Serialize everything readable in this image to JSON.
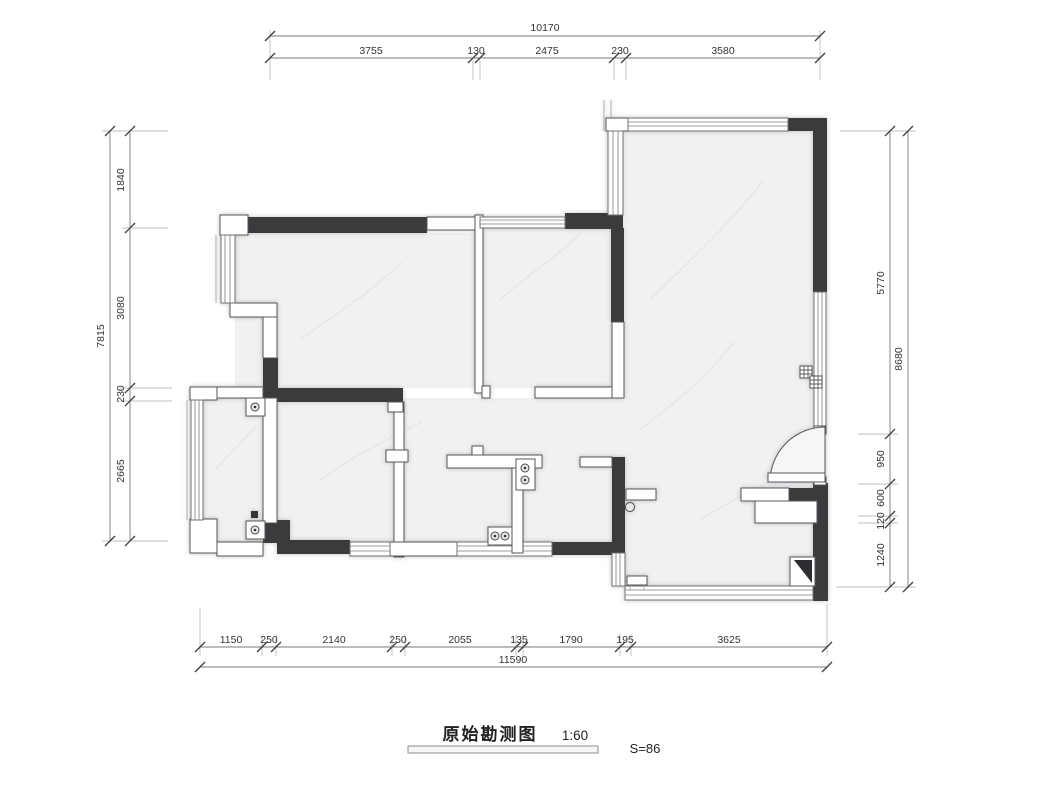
{
  "title_block": {
    "title": "原始勘测图",
    "scale_label": "1:60",
    "area_label": "S=86"
  },
  "dimensions": {
    "top": {
      "total": "10170",
      "segments": [
        "3755",
        "130",
        "2475",
        "230",
        "3580"
      ]
    },
    "left": {
      "total": "7815",
      "segments": [
        "1840",
        "3080",
        "230",
        "2665"
      ]
    },
    "right": {
      "total": "8680",
      "segments": [
        "5770",
        "950",
        "600",
        "120",
        "1240"
      ]
    },
    "bottom": {
      "total": "11590",
      "segments": [
        "1150",
        "250",
        "2140",
        "250",
        "2055",
        "135",
        "1790",
        "195",
        "3625"
      ]
    }
  },
  "colors": {
    "wall": "#3a3a3d",
    "floor": "#f1f1f2",
    "dim_text": "#333335"
  }
}
